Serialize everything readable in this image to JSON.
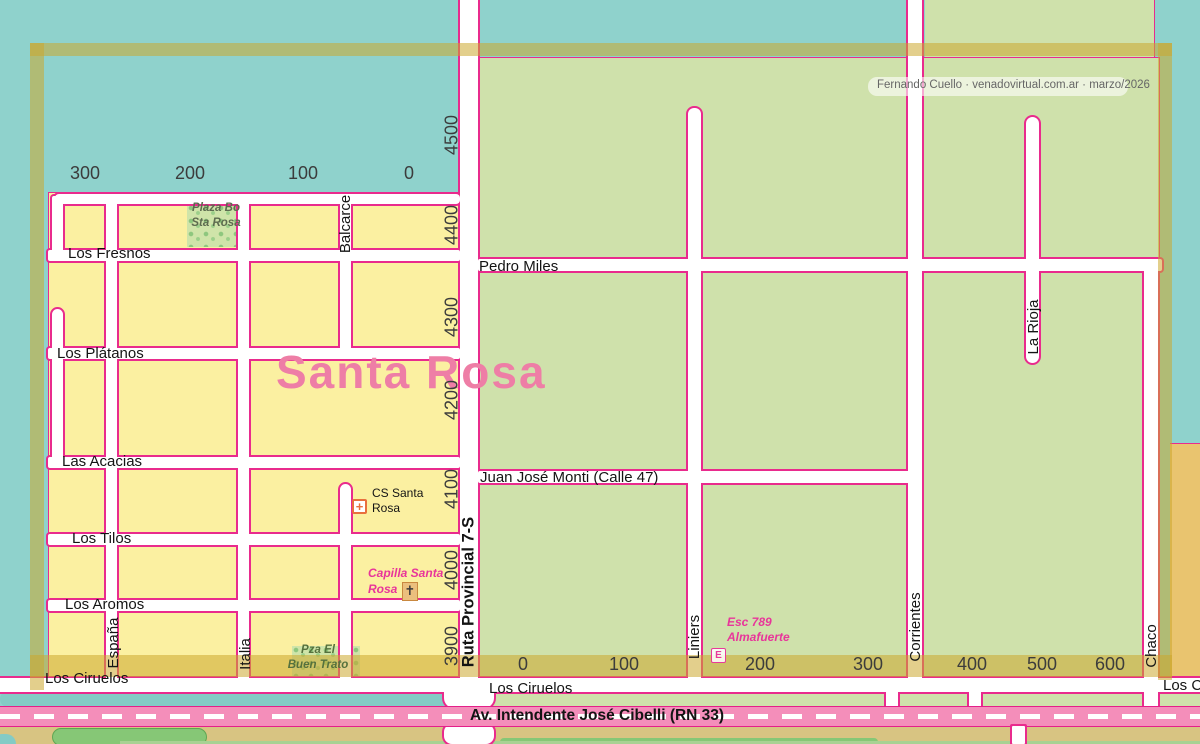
{
  "title": "Santa Rosa",
  "attribution": "Fernando Cuello · venadovirtual.com.ar · marzo/2026",
  "streets": {
    "los_fresnos": "Los Fresnos",
    "pedro_miles": "Pedro Miles",
    "los_platanos": "Los Plátanos",
    "las_acacias": "Las Acacias",
    "juan_jose_monti": "Juan José Monti (Calle 47)",
    "los_tilos": "Los Tilos",
    "los_aromos": "Los Aromos",
    "los_ciruelos": "Los Ciruelos",
    "espana": "España",
    "italia": "Italia",
    "balcarce": "Balcarce",
    "ruta": "Ruta Provincial 7-S",
    "liniers": "Liniers",
    "corrientes": "Corrientes",
    "la_rioja": "La Rioja",
    "chaco": "Chaco",
    "avenida": "Av. Intendente José Cibelli (RN 33)"
  },
  "grid": {
    "top": [
      "300",
      "200",
      "100",
      "0"
    ],
    "bottom": [
      "0",
      "100",
      "200",
      "300",
      "400",
      "500",
      "600"
    ],
    "west": [
      "4500",
      "4400",
      "4300",
      "4200",
      "4100",
      "4000",
      "3900"
    ]
  },
  "pois": {
    "plaza_sta_rosa": {
      "line1": "Plaza Bo",
      "line2": "Sta Rosa"
    },
    "pza_buen_trato": {
      "line1": "Pza El",
      "line2": "Buen Trato"
    },
    "cs_santa_rosa": {
      "line1": "CS Santa",
      "line2": "Rosa"
    },
    "capilla_santa_rosa": {
      "line1": "Capilla Santa",
      "line2": "Rosa"
    },
    "esc_almafuerte": {
      "line1": "Esc 789",
      "line2": "Almafuerte"
    }
  },
  "icons": {
    "health_symbol": "+",
    "chapel_symbol": "✝",
    "school_symbol": "E"
  },
  "colors": {
    "teal": "#8fd2cc",
    "canal": "#84cbc5",
    "zone_yellow": "#fbf0a1",
    "zone_green": "#cfe1ab",
    "zone_gold": "#e9c46f",
    "outline_pink": "#e92b8d",
    "road_pink": "#f48eba",
    "title_pink": "#ee7ea6",
    "frame_gold": "rgba(204,168,45,0.55)",
    "tan": "#d8c482",
    "vegetation": "#86c776"
  }
}
